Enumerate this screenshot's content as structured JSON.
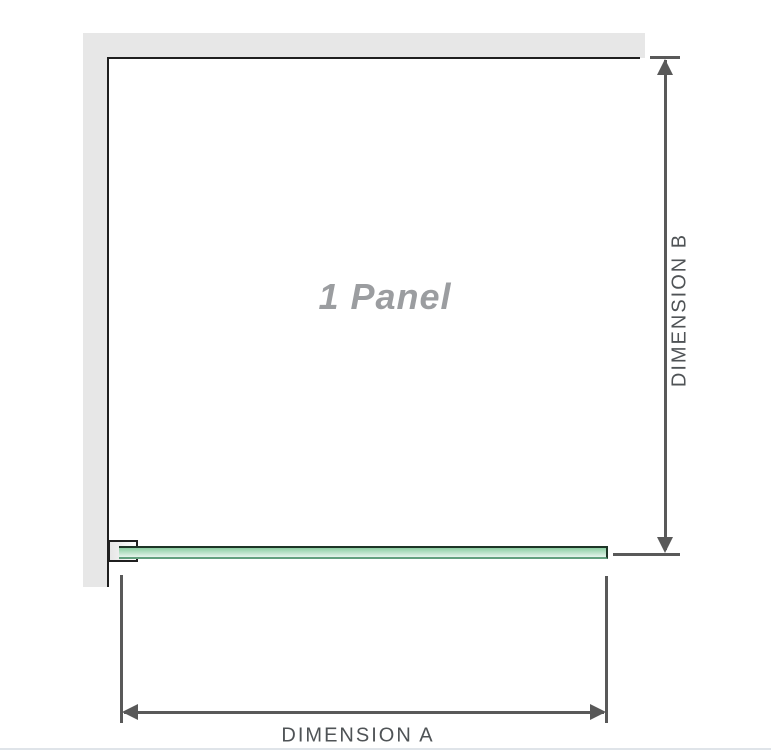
{
  "diagram": {
    "panel_label": "1 Panel",
    "dimension_a_label": "DIMENSION A",
    "dimension_b_label": "DIMENSION B"
  },
  "colors": {
    "background": "#ffffff",
    "wall_fill": "#e7e7e7",
    "wall_edge": "#1f1f1f",
    "dimension_line": "#595959",
    "dimension_text": "#4f5356",
    "panel_label_text": "#9b9da0",
    "glass_fill_top": "#8bcea2",
    "glass_fill_bottom": "#e6f4ec",
    "glass_edge_dark": "#1e3527",
    "glass_edge_light": "#62a07e",
    "bracket_border": "#1f1f1f",
    "bracket_fill_a": "#e6e6e6",
    "bracket_fill_b": "#fdfdfd",
    "bottom_rule": "#dfe4e9"
  }
}
